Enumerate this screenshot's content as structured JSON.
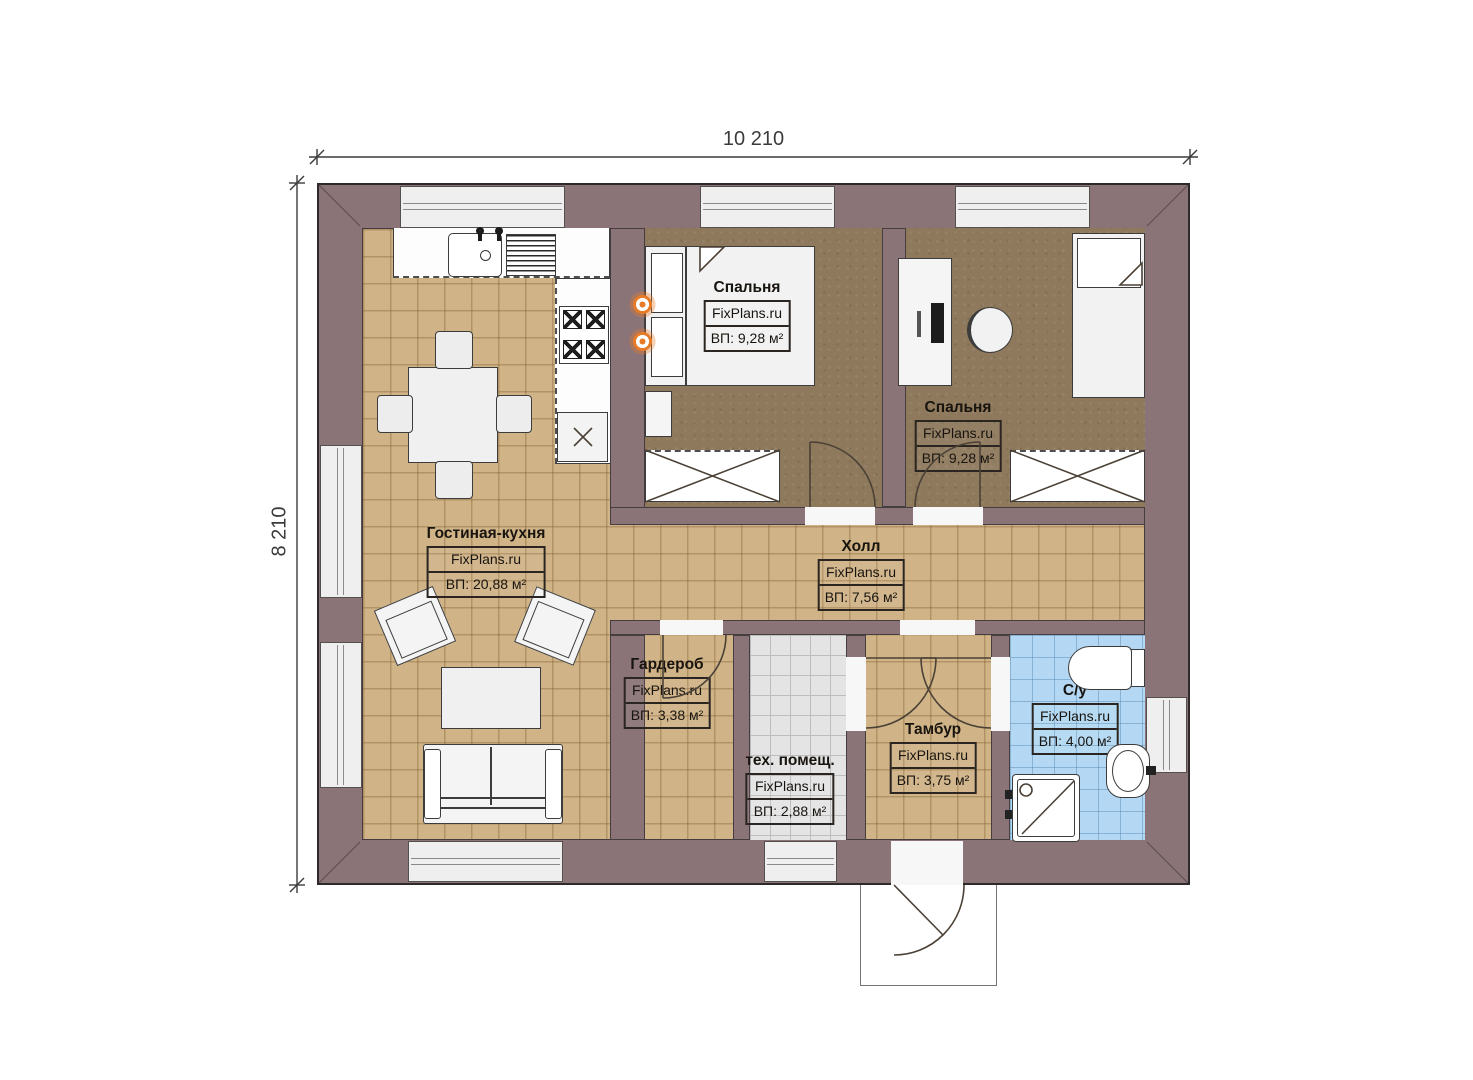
{
  "watermark": "FixPlans.ru",
  "dimensions": {
    "width": "10 210",
    "height": "8 210"
  },
  "rooms": {
    "bedroom1": {
      "name": "Спальня",
      "watermark": "FixPlans.ru",
      "area": "ВП: 9,28 м²"
    },
    "bedroom2": {
      "name": "Спальня",
      "watermark": "FixPlans.ru",
      "area": "ВП: 9,28 м²"
    },
    "living": {
      "name": "Гостиная-кухня",
      "watermark": "FixPlans.ru",
      "area": "ВП: 20,88 м²"
    },
    "hall": {
      "name": "Холл",
      "watermark": "FixPlans.ru",
      "area": "ВП: 7,56 м²"
    },
    "wardrobe": {
      "name": "Гардероб",
      "watermark": "FixPlans.ru",
      "area": "ВП: 3,38 м²"
    },
    "tech": {
      "name": "тех. помещ.",
      "watermark": "FixPlans.ru",
      "area": "ВП: 2,88 м²"
    },
    "vestibule": {
      "name": "Тамбур",
      "watermark": "FixPlans.ru",
      "area": "ВП: 3,75 м²"
    },
    "bathroom": {
      "name": "С/у",
      "watermark": "FixPlans.ru",
      "area": "ВП: 4,00 м²"
    }
  },
  "colors": {
    "wall": "#8b7478",
    "floor_wood": "#d0b488",
    "floor_bedroom": "#8e795c",
    "floor_tech": "#e4e4e4",
    "floor_bath": "#b4d8f3",
    "accent_orange": "#e77b28"
  }
}
